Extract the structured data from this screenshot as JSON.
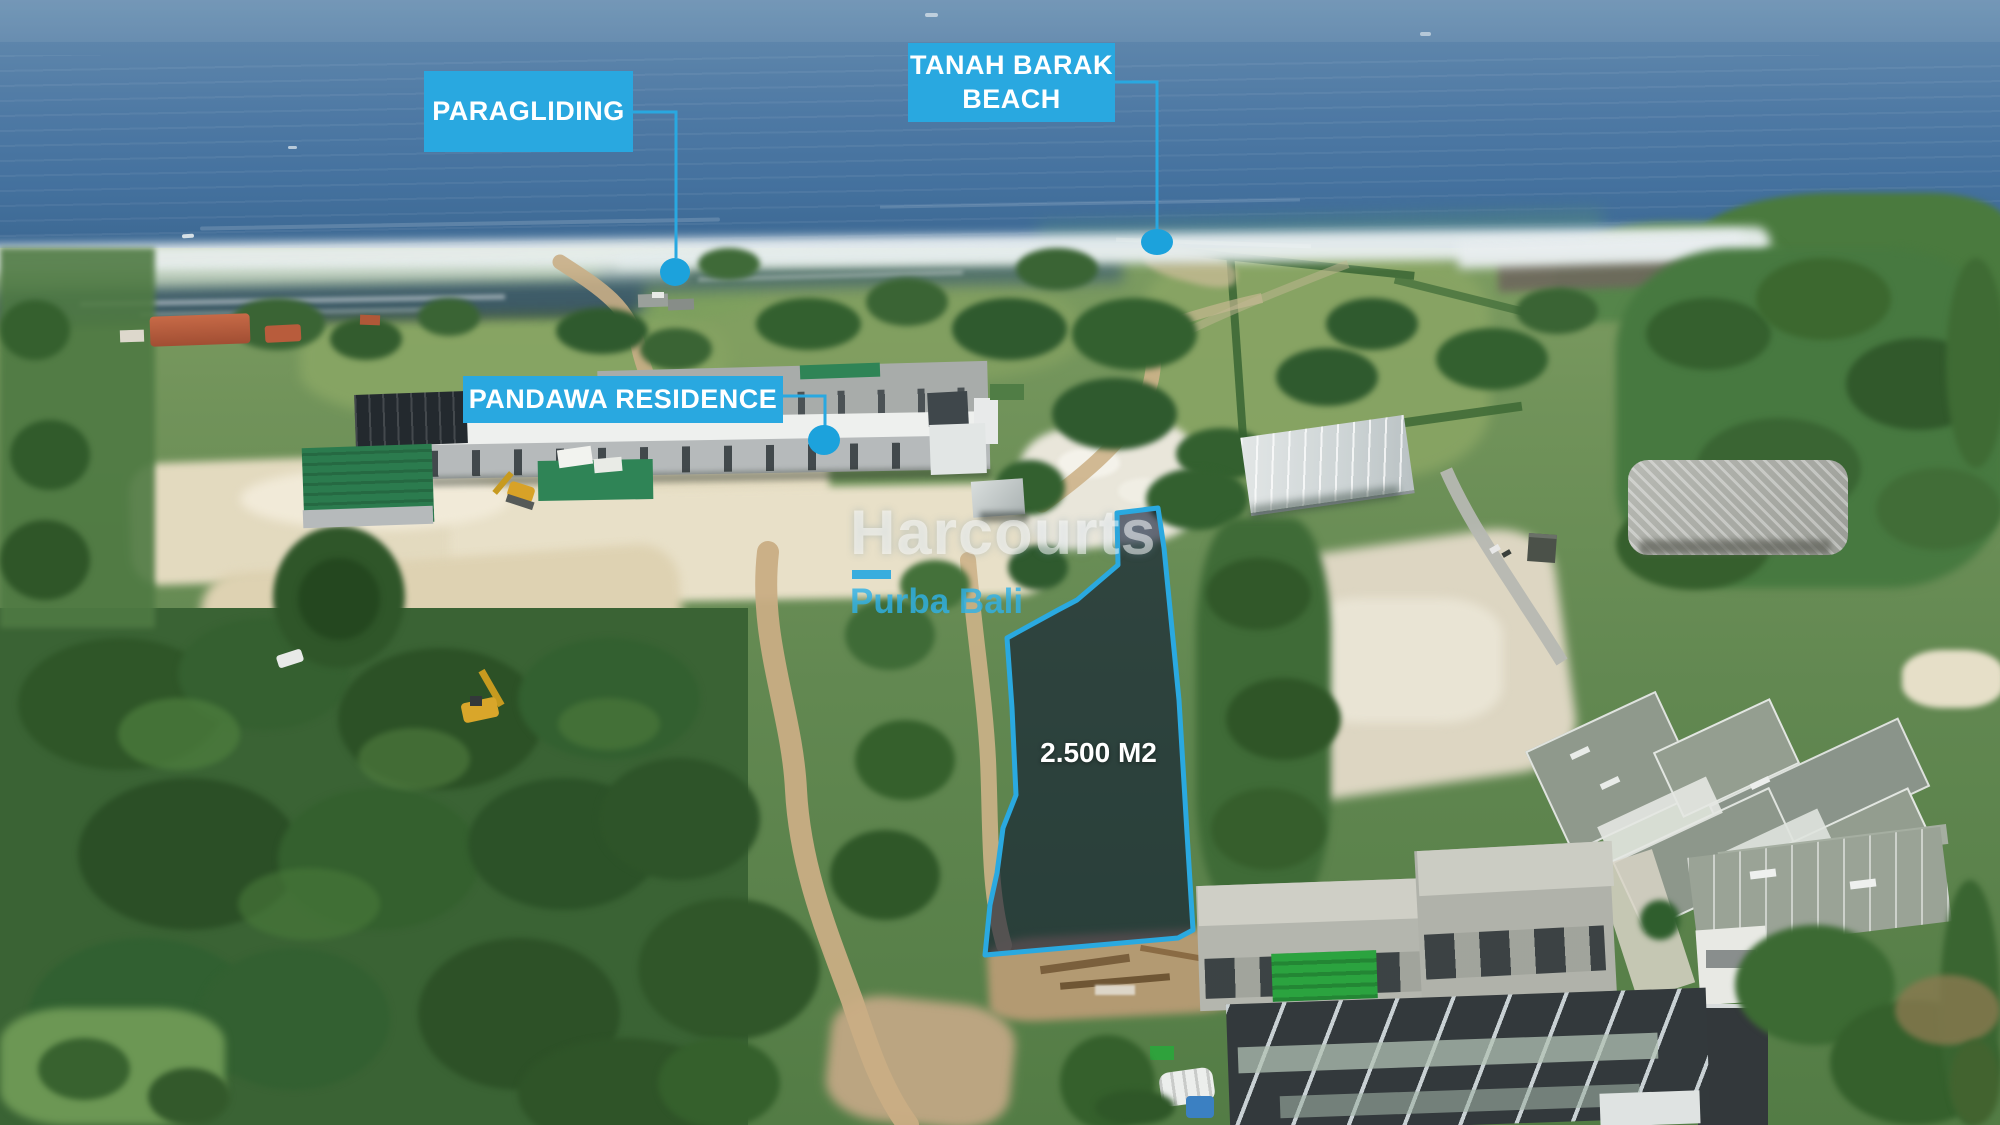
{
  "labels": {
    "paragliding": "PARAGLIDING",
    "tanah_barak_line1": "TANAH BARAK",
    "tanah_barak_line2": "BEACH",
    "pandawa_residence": "PANDAWA RESIDENCE",
    "plot_area": "2.500 M2"
  },
  "watermark": {
    "brand": "Harcourts",
    "subbrand": "Purba Bali"
  },
  "colors": {
    "accent_cyan": "#29A8E0",
    "marker_cyan": "#1CA2DC",
    "plot_stroke": "#2AA9E0",
    "plot_fill": "rgba(10,20,48,0.6)",
    "label_text": "#FFFFFF",
    "watermark_white": "rgba(255,255,255,0.52)",
    "watermark_blue": "rgba(47,177,230,0.82)"
  }
}
